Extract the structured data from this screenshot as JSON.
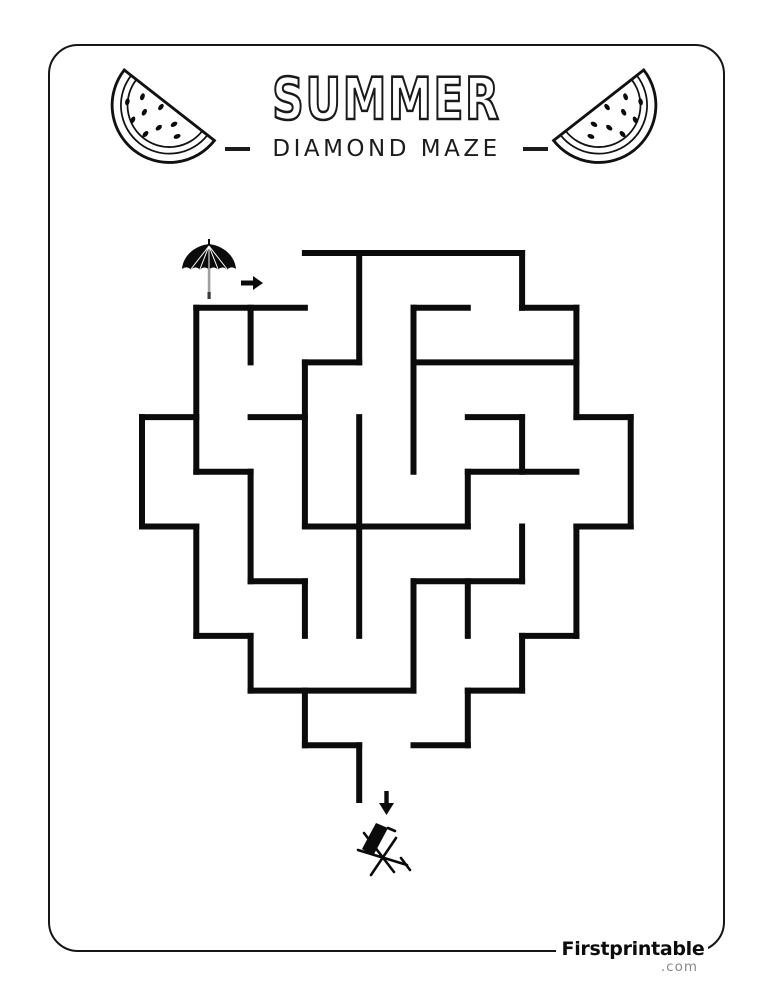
{
  "header": {
    "title": "SUMMER",
    "subtitle": "DIAMOND MAZE"
  },
  "footer": {
    "brand": "Firstprintable",
    "domain": ".com"
  },
  "colors": {
    "ink": "#0b0b0b",
    "border": "#161616",
    "muted_gray": "#8a8a8a",
    "pole_gray": "#a0a0a0"
  },
  "icons": {
    "decor_left": "watermelon-slice-icon",
    "decor_right": "watermelon-slice-icon",
    "maze_start": "beach-umbrella-icon",
    "maze_start_arrow": "right-arrow-icon",
    "maze_end_arrow": "down-arrow-icon",
    "maze_end": "deck-chair-icon"
  },
  "maze": {
    "shape": "diamond",
    "grid_cols": 9,
    "grid_rows": 10,
    "origin_x": 142,
    "origin_y": 253,
    "cell_w": 54.3,
    "cell_h": 54.7,
    "stroke_width": 6,
    "wall_color": "#0b0b0b",
    "entrance": "top-left row 0, open on left, marked by umbrella and right arrow",
    "exit": "bottom gap between nodes (4,9) and (5,9), marked by down arrow and deck chair",
    "walls": [
      [
        3,
        0,
        7,
        0
      ],
      [
        1,
        1,
        3,
        1
      ],
      [
        5,
        1,
        6,
        1
      ],
      [
        7,
        1,
        8,
        1
      ],
      [
        3,
        2,
        4,
        2
      ],
      [
        5,
        2,
        8,
        2
      ],
      [
        0,
        3,
        1,
        3
      ],
      [
        2,
        3,
        3,
        3
      ],
      [
        6,
        3,
        7,
        3
      ],
      [
        8,
        3,
        9,
        3
      ],
      [
        1,
        4,
        2,
        4
      ],
      [
        6,
        4,
        8,
        4
      ],
      [
        0,
        5,
        1,
        5
      ],
      [
        3,
        5,
        6,
        5
      ],
      [
        8,
        5,
        9,
        5
      ],
      [
        2,
        6,
        3,
        6
      ],
      [
        5,
        6,
        7,
        6
      ],
      [
        1,
        7,
        2,
        7
      ],
      [
        7,
        7,
        8,
        7
      ],
      [
        2,
        8,
        5,
        8
      ],
      [
        6,
        8,
        7,
        8
      ],
      [
        3,
        9,
        4,
        9
      ],
      [
        5,
        9,
        6,
        9
      ],
      [
        0,
        3,
        0,
        5
      ],
      [
        1,
        1,
        1,
        4
      ],
      [
        1,
        5,
        1,
        7
      ],
      [
        2,
        1,
        2,
        2
      ],
      [
        2,
        4,
        2,
        6
      ],
      [
        2,
        7,
        2,
        8
      ],
      [
        3,
        2,
        3,
        5
      ],
      [
        3,
        6,
        3,
        7
      ],
      [
        3,
        8,
        3,
        9
      ],
      [
        4,
        0,
        4,
        2
      ],
      [
        4,
        3,
        4,
        7
      ],
      [
        4,
        9,
        4,
        10
      ],
      [
        5,
        1,
        5,
        4
      ],
      [
        5,
        6,
        5,
        8
      ],
      [
        6,
        4,
        6,
        5
      ],
      [
        6,
        6,
        6,
        7
      ],
      [
        6,
        8,
        6,
        9
      ],
      [
        7,
        0,
        7,
        1
      ],
      [
        7,
        3,
        7,
        4
      ],
      [
        7,
        5,
        7,
        6
      ],
      [
        7,
        7,
        7,
        8
      ],
      [
        8,
        1,
        8,
        3
      ],
      [
        8,
        5,
        8,
        7
      ],
      [
        9,
        3,
        9,
        5
      ]
    ]
  }
}
